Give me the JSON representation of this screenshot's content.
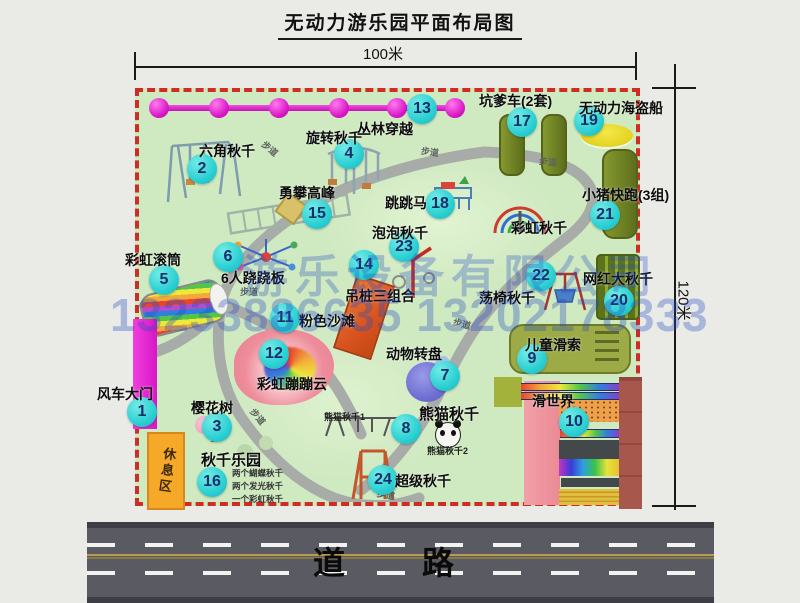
{
  "title": "无动力游乐园平面布局图",
  "dimensions": {
    "width_label": "100米",
    "height_label": "120米"
  },
  "road": {
    "label": "道  路"
  },
  "watermark": {
    "company": "游乐设备有限公司",
    "phone": "13233886635 13202178333"
  },
  "path_label": "步道",
  "zones": {
    "rest_area": "休息区"
  },
  "extra_labels": {
    "rainbow_swing": "彩虹秋千"
  },
  "attractions": [
    {
      "num": 1,
      "label": "风车大门"
    },
    {
      "num": 2,
      "label": "六角秋千"
    },
    {
      "num": 3,
      "label": "樱花树"
    },
    {
      "num": 4,
      "label": "旋转秋千"
    },
    {
      "num": 5,
      "label": "彩虹滚筒"
    },
    {
      "num": 6,
      "label": "6人跷跷板"
    },
    {
      "num": 7,
      "label": "动物转盘"
    },
    {
      "num": 8,
      "label": "熊猫秋千",
      "sub": [
        "熊猫秋千1",
        "熊猫秋千2"
      ]
    },
    {
      "num": 9,
      "label": "儿童滑索"
    },
    {
      "num": 10,
      "label": "滑世界"
    },
    {
      "num": 11,
      "label": "粉色沙滩"
    },
    {
      "num": 12,
      "label": "彩虹蹦蹦云"
    },
    {
      "num": 13,
      "label": "丛林穿越"
    },
    {
      "num": 14,
      "label": "吊桩三组合"
    },
    {
      "num": 15,
      "label": "勇攀高峰"
    },
    {
      "num": 16,
      "label": "秋千乐园",
      "notes": [
        "两个蝴蝶秋千",
        "两个发光秋千",
        "一个彩虹秋千"
      ]
    },
    {
      "num": 17,
      "label": "坑爹车(2套)"
    },
    {
      "num": 18,
      "label": "跳跳马"
    },
    {
      "num": 19,
      "label": "无动力海盗船"
    },
    {
      "num": 20,
      "label": "网红大秋千"
    },
    {
      "num": 21,
      "label": "小猪快跑(3组)"
    },
    {
      "num": 22,
      "label": "荡椅秋千"
    },
    {
      "num": 23,
      "label": "泡泡秋千"
    },
    {
      "num": 24,
      "label": "超级秋千"
    }
  ],
  "colors": {
    "park_green": "#cfe9c1",
    "border_red": "#cf2c26",
    "magenta": "#d816c6",
    "badge_teal": "#2bd0d3",
    "path_gray": "#a7aca8",
    "road_gray": "#5a5a63",
    "watermark_blue": "#234bc3"
  }
}
